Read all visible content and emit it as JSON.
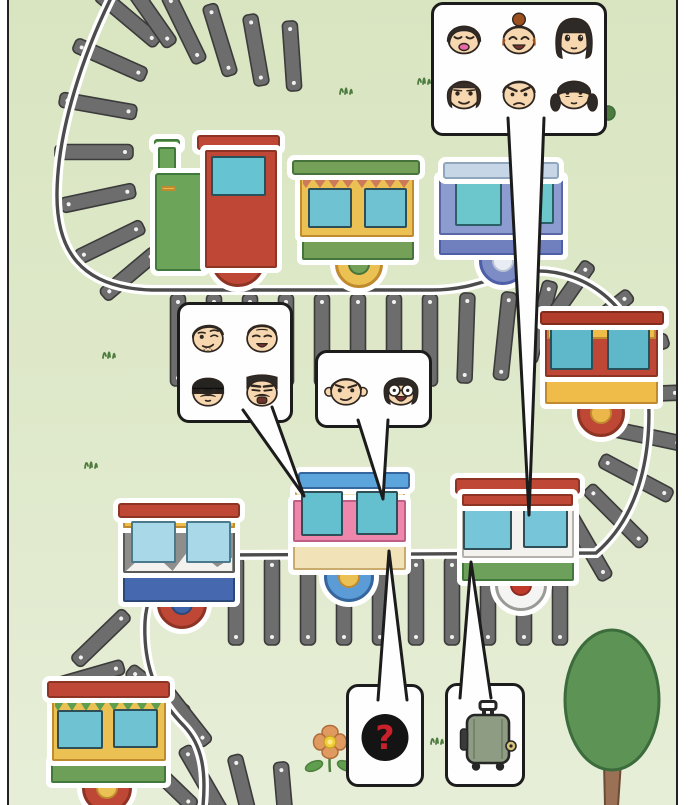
{
  "scene": {
    "description": "Cartoon railway panel: a winding track with toy trains; speech bubbles show passenger faces, a mystery mark and a suitcase",
    "background_top": "#d9e5c1",
    "background_bottom": "#e7eed8",
    "page_color": "#ffffff",
    "panel_border_color": "#222222"
  },
  "track": {
    "tie_color": "#6d6d6d",
    "tie_border": "#3b3b3b",
    "tie_dot_color": "#ffffff",
    "rail_color": "#4c4c4c",
    "rail_halo_color": "#ffffff"
  },
  "speech_bubbles": {
    "top_right": {
      "name": "six-passengers",
      "faces": [
        {
          "icon": "face-boy-bowl-cut-smiling",
          "hair": "bowl",
          "hair_color": "#2e2a28",
          "eyes": "happy",
          "mouth": "open-pink"
        },
        {
          "icon": "face-woman-bun-laughing",
          "hair": "bun",
          "hair_color": "#9c501d",
          "eyes": "closedup",
          "mouth": "laugh"
        },
        {
          "icon": "face-woman-long-hair",
          "hair": "long",
          "hair_color": "#2e2a28",
          "eyes": "big",
          "mouth": "tiny"
        },
        {
          "icon": "face-woman-side-hair-smiling",
          "hair": "curtain",
          "hair_color": "#3a2f28",
          "eyes": "sly",
          "mouth": "smile"
        },
        {
          "icon": "face-man-angry",
          "hair": "short",
          "hair_color": "#2e2a28",
          "eyes": "angry",
          "mouth": "frown"
        },
        {
          "icon": "face-girl-pigtails",
          "hair": "pigtails",
          "hair_color": "#2e2a28",
          "eyes": "timid",
          "mouth": "tiny"
        }
      ]
    },
    "mid_left": {
      "name": "four-passengers",
      "faces": [
        {
          "icon": "face-man-wink-stubble",
          "hair": "sideshort",
          "hair_color": "#2e2a28",
          "eyes": "wink",
          "mouth": "smirk",
          "extras": [
            "stubble"
          ]
        },
        {
          "icon": "face-old-man-grinning",
          "hair": "grayshort",
          "hair_color": "#b5b2ae",
          "eyes": "squint",
          "mouth": "grin"
        },
        {
          "icon": "face-man-beanie-mustache",
          "hair": "beanie",
          "hair_color": "#262421",
          "eyes": "dot",
          "mouth": "tiny",
          "extras": [
            "mustache"
          ]
        },
        {
          "icon": "face-man-flattop-mustache",
          "hair": "flattop",
          "hair_color": "#2e2a28",
          "eyes": "stern",
          "mouth": "grimopen",
          "extras": [
            "mustache"
          ]
        }
      ]
    },
    "mid_center": {
      "name": "two-passengers",
      "faces": [
        {
          "icon": "face-man-big-ears-smirk",
          "hair": "short",
          "hair_color": "#2e2a28",
          "eyes": "smug",
          "mouth": "smirk",
          "extras": [
            "bigears"
          ]
        },
        {
          "icon": "face-woman-bob-glasses",
          "hair": "bob",
          "hair_color": "#2e2a28",
          "eyes": "glasses",
          "mouth": "laugh"
        }
      ]
    },
    "mystery": {
      "name": "unknown-passenger",
      "glyph": "?",
      "circle_color": "#141414",
      "glyph_color": "#c9202c"
    },
    "luggage": {
      "name": "suitcase",
      "icon": "suitcase-icon",
      "case_color": "#8d9c82",
      "trim_color": "#262626",
      "tag_color": "#d8c27a"
    }
  },
  "train_cars": [
    {
      "id": "locomotive",
      "kind": "steam-engine",
      "colors": {
        "cab": "#bf4736",
        "cab_border": "#8e3425",
        "boiler": "#6ca45a",
        "boiler_border": "#41793d",
        "stripe": "#ecb74a",
        "window": "#66c3d2",
        "window_border": "#27525c",
        "wheel": "#bf4736",
        "wheel_border": "#8e3425",
        "hub": "#ecb74a",
        "hub_border": "#c08a2e"
      }
    },
    {
      "id": "car-green-yellow",
      "kind": "coach",
      "colors": {
        "roof": "#74a058",
        "roof_border": "#47743a",
        "body": "#ecc153",
        "body_border": "#c08a2e",
        "trim": "#cd7a5a",
        "windows": "#6ec2d2",
        "window_border": "#2f4f58",
        "skirt": "#74a058",
        "skirt_border": "#47743a",
        "wheel": "#ecc153",
        "wheel_border": "#c08a2e",
        "hub": "#74a058",
        "hub_border": "#47743a"
      }
    },
    {
      "id": "car-blue",
      "kind": "coach",
      "colors": {
        "roof": "#c7d6e6",
        "roof_border": "#8fa6bd",
        "body": "#8d9cd0",
        "body_border": "#5a68a8",
        "windows": "#6cc7cc",
        "window_border": "#2a6066",
        "skirt": "#707fbd",
        "skirt_border": "#4d5fa6",
        "wheel": "#7d8cc4",
        "wheel_border": "#4d5fa6",
        "hub": "#e8edf5",
        "hub_border": "#b8c2d4"
      }
    },
    {
      "id": "car-red-yellow",
      "kind": "coach",
      "colors": {
        "roof": "#b33d2c",
        "roof_border": "#822c1e",
        "body": "#bf4736",
        "body_border": "#8e3425",
        "band": "#f0bc49",
        "windows": "#5fb8c9",
        "window_border": "#27525c",
        "skirt": "#f0bc49",
        "skirt_border": "#c08a2e",
        "wheel": "#bf4736",
        "wheel_border": "#8e3425",
        "hub": "#ecb74a",
        "hub_border": "#c08a2e"
      }
    },
    {
      "id": "car-white-green",
      "kind": "coach",
      "colors": {
        "roof": "#bf4736",
        "roof_border": "#8e3425",
        "body": "#f4f2ee",
        "body_border": "#b5b2ac",
        "windows": "#76c5d8",
        "window_border": "#2f4f58",
        "skirt": "#6da05a",
        "skirt_border": "#41793d",
        "wheel": "#f4f4f2",
        "wheel_border": "#9a9a96",
        "hub": "#c03a2c",
        "hub_border": "#8e2a20"
      }
    },
    {
      "id": "car-pink",
      "kind": "coach",
      "colors": {
        "roof": "#5ba4dc",
        "roof_border": "#35679e",
        "band": "#f2e2b8",
        "band_border": "#c9ab6d",
        "body": "#ef87ad",
        "body_border": "#c05f86",
        "windows": "#64c0cf",
        "window_border": "#2f4f58",
        "skirt": "#f2e2b8",
        "skirt_border": "#c9ab6d",
        "wheel": "#5b9bd6",
        "wheel_border": "#35679e",
        "hub": "#ecc153",
        "hub_border": "#c08a2e"
      }
    },
    {
      "id": "car-gray-mountain",
      "kind": "coach",
      "colors": {
        "roof": "#bf4736",
        "roof_border": "#8e3425",
        "band": "#f0bc49",
        "band_border": "#c08a2e",
        "body": "#8e8e8c",
        "body_border": "#5a5a58",
        "mountains": "#f4f2ee",
        "windows": "#a9d8e8",
        "window_border": "#4a7a8c",
        "skirt": "#4568ae",
        "skirt_border": "#2a4878",
        "wheel": "#bf4736",
        "wheel_border": "#8e3425",
        "hub": "#3f63a8",
        "hub_border": "#2a4878"
      }
    },
    {
      "id": "car-bottom-yellow",
      "kind": "coach",
      "colors": {
        "roof": "#bf4736",
        "roof_border": "#8e3425",
        "body": "#ecc153",
        "body_border": "#c08a2e",
        "trim": "#5f9e4f",
        "windows": "#6ec2d2",
        "window_border": "#2f4f58",
        "skirt": "#6d9f58",
        "skirt_border": "#41793d",
        "wheel": "#bf4736",
        "wheel_border": "#8e3425",
        "hub": "#ecc153",
        "hub_border": "#c08a2e"
      }
    }
  ],
  "decorations": {
    "tree": {
      "canopy": "#5d9355",
      "canopy_border": "#3c6b3c",
      "trunk": "#9b7156",
      "trunk_border": "#6b4a36"
    },
    "flower": {
      "petals": "#e09a5f",
      "petal_border": "#b06b3a",
      "center": "#f2cf3a",
      "leaves": "#5f9e4f",
      "stem": "#4e7f3c"
    },
    "grass_color": "#4d7c3e",
    "skin_color": "#f7d7b0",
    "line_color": "#2f2620"
  }
}
